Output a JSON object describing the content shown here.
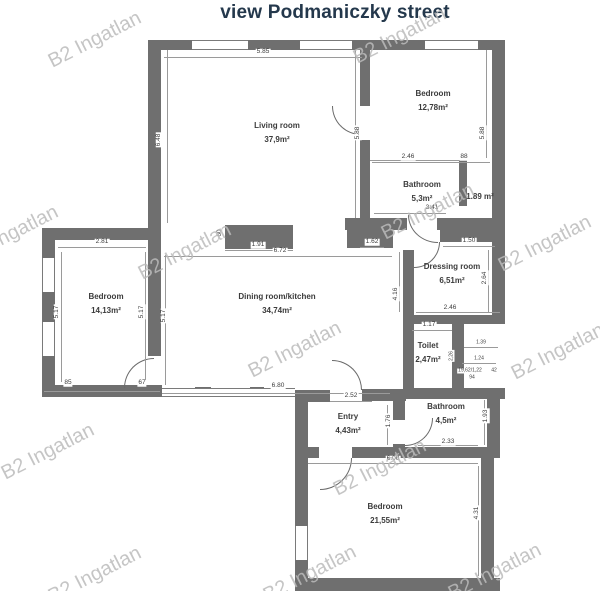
{
  "title": "view Podmaniczky street",
  "watermark": {
    "text": "B2 Ingatlan"
  },
  "colors": {
    "title": "#24384c",
    "wall": "#6f6f6f",
    "watermark": "#c2c2c2",
    "background": "#ffffff"
  },
  "rooms": [
    {
      "name": "Living room",
      "area": "37,9m²"
    },
    {
      "name": "Bedroom",
      "area": "12,78m²"
    },
    {
      "name": "Bathroom",
      "area": "5,3m²"
    },
    {
      "name": "",
      "area": "1.89 m²"
    },
    {
      "name": "Dressing room",
      "area": "6,51m²"
    },
    {
      "name": "Bedroom",
      "area": "14,13m²"
    },
    {
      "name": "Dining room/kitchen",
      "area": "34,74m²"
    },
    {
      "name": "Toilet",
      "area": "2,47m²"
    },
    {
      "name": "Entry",
      "area": "4,43m²"
    },
    {
      "name": "Bathroom",
      "area": "4,5m²"
    },
    {
      "name": "Bedroom",
      "area": "21,55m²"
    }
  ],
  "dims": [
    "5.85",
    "6.48",
    "5.88",
    "5.88",
    "2.46",
    "88",
    "3.41",
    "1.62",
    "1.50",
    "2.64",
    "2.46",
    "4.16",
    "2.81",
    "5.17",
    "5.17",
    "5.17",
    "85",
    "67",
    "1.91",
    "6.72",
    "60",
    "6.80",
    "1.17",
    "2,26",
    "1.39",
    "1.24",
    "19,62/1,22",
    "42",
    "94",
    "2.52",
    "1.76",
    "2.33",
    "1.93",
    "6.00",
    "4.31"
  ]
}
